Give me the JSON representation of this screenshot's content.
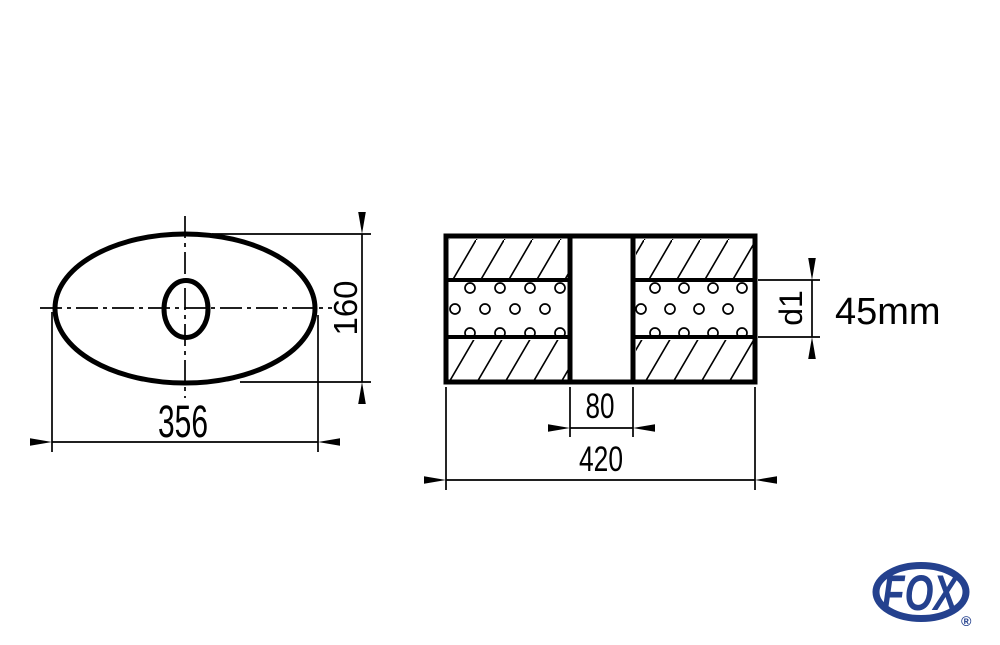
{
  "drawing": {
    "front_view": {
      "dim_width_label": "356",
      "dim_height_label": "160"
    },
    "section_view": {
      "dim_gap_label": "80",
      "dim_length_label": "420",
      "dim_tube_label": "d1",
      "tube_diameter_note": "45mm"
    }
  },
  "logo": {
    "text": "FOX",
    "registered_mark": "®"
  },
  "colors": {
    "line": "#000000",
    "logo_blue": "#24418E",
    "background": "#FFFFFF"
  }
}
